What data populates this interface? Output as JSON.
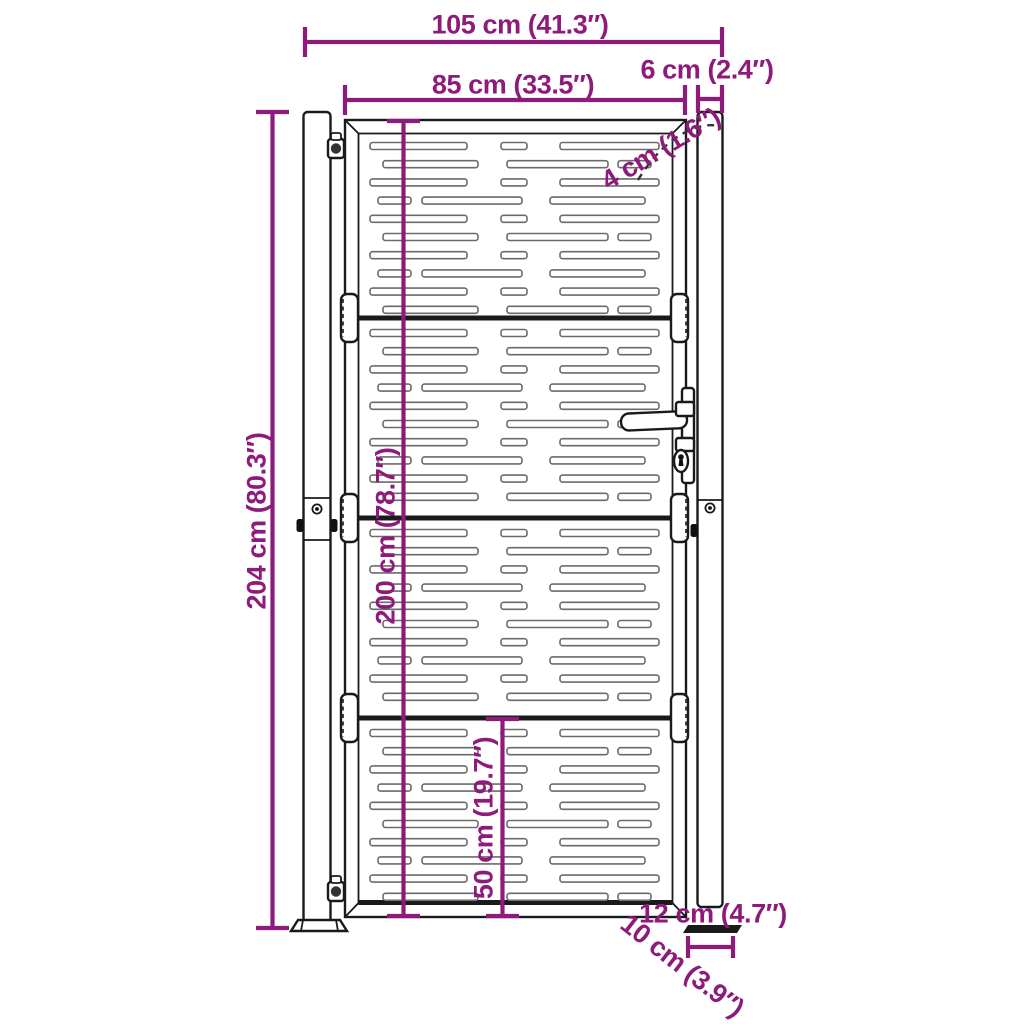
{
  "title": "Garden gate dimension diagram",
  "colors": {
    "dimension": "#8e1a7b",
    "line": "#1a1a1a",
    "slat_outline": "#6b6b6b"
  },
  "labels": {
    "overall_width": "105 cm (41.3″)",
    "gate_width": "85 cm (33.5″)",
    "post_width": "6 cm (2.4″)",
    "frame_profile": "4 cm (1.6″)",
    "overall_height": "204 cm (80.3″)",
    "gate_height": "200 cm (78.7″)",
    "bottom_panel_height": "50 cm (19.7″)",
    "base_plate_length": "12 cm (4.7″)",
    "base_plate_depth": "10 cm (3.9″)"
  },
  "gate": {
    "panel_tops": [
      133.5,
      320.5,
      520.5,
      720.5
    ],
    "rows_per_panel": 10,
    "row_offset": 9,
    "row_spacing": 18.2,
    "slot_height": 7,
    "slot_radius": 2.5,
    "patterns": {
      "A": [
        [
          370,
          97
        ],
        [
          501,
          26
        ],
        [
          560,
          99
        ]
      ],
      "B": [
        [
          383,
          95
        ],
        [
          507,
          101
        ],
        [
          618,
          33
        ]
      ],
      "C": [
        [
          378,
          33
        ],
        [
          422,
          100
        ],
        [
          550,
          95
        ]
      ]
    },
    "sequence": [
      "A",
      "B",
      "A",
      "C",
      "A",
      "B",
      "A",
      "C",
      "A",
      "B"
    ]
  }
}
